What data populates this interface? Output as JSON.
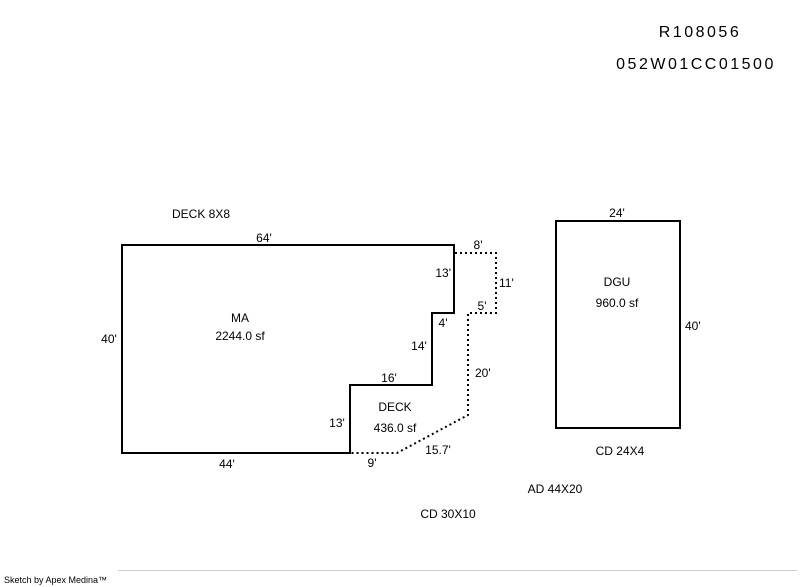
{
  "header": {
    "record_id": "R108056",
    "parcel_id": "052W01CC01500"
  },
  "sketch": {
    "deck_note": "DECK 8X8",
    "main_area": {
      "label": "MA",
      "area": "2244.0 sf",
      "dim_top": "64'",
      "dim_left": "40'",
      "dim_bottom": "44'",
      "dim_right_upper": "13'",
      "dim_step_4": "4'",
      "dim_right_mid": "14'",
      "dim_step_16": "16'"
    },
    "addition": {
      "label": "AD 44X20",
      "dim_top": "8'",
      "dim_right": "11'",
      "dim_inner_top": "5'",
      "dim_right_lower": "20'",
      "dim_diagonal": "15.7'"
    },
    "deck": {
      "label": "DECK",
      "area": "436.0 sf",
      "dim_left": "13'",
      "dim_bottom": "9'"
    },
    "garage": {
      "label": "DGU",
      "area": "960.0 sf",
      "dim_top": "24'",
      "dim_right": "40'",
      "note": "CD 24X4"
    },
    "cd_note": "CD 30X10"
  },
  "footer": {
    "credit": "Sketch by Apex Medina™"
  },
  "colors": {
    "line": "#000000",
    "text": "#000000",
    "background": "#ffffff",
    "footer_rule": "#cccccc"
  }
}
